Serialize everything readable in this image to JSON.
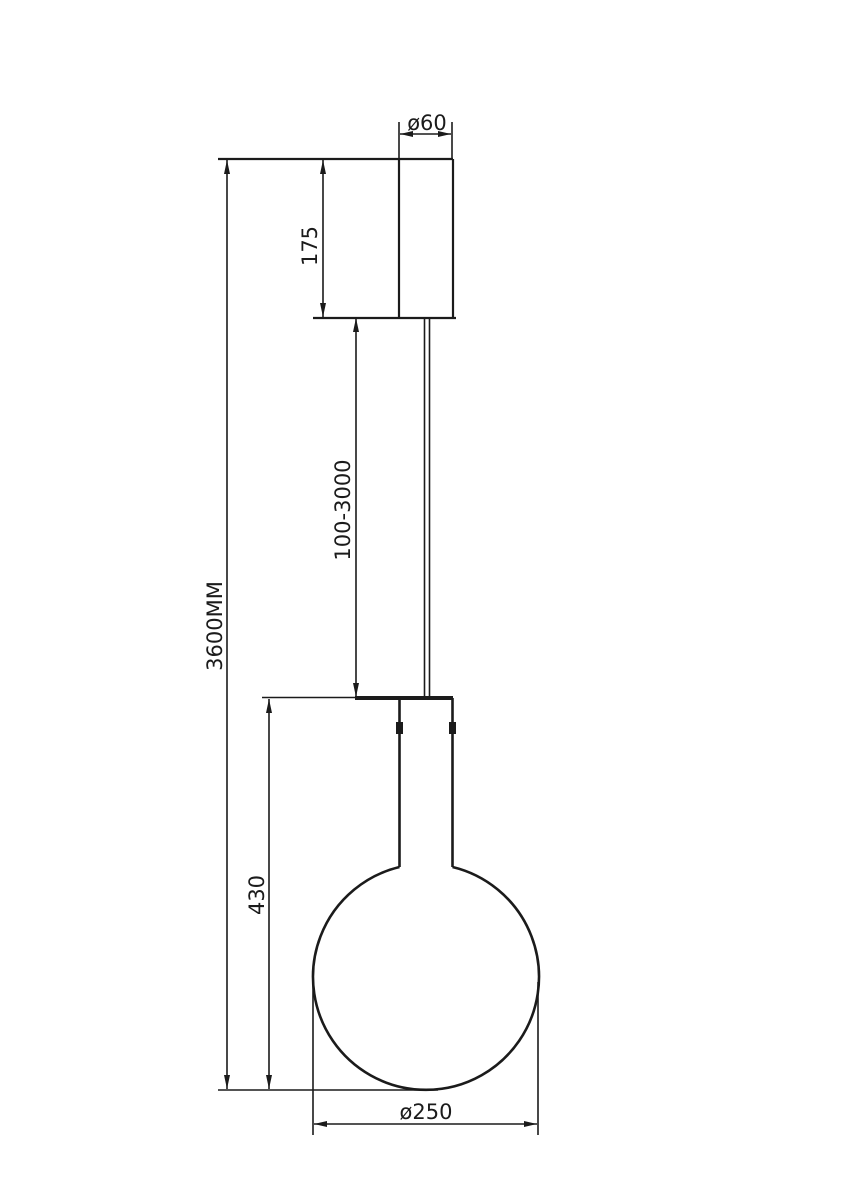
{
  "page": {
    "background": "#ffffff",
    "line_color": "#1b1b1b"
  },
  "drawing": {
    "kind": "technical-dimension-diagram",
    "subject": "pendant-lamp-side-view",
    "labels": {
      "canopy_diameter": "ø60",
      "canopy_height": "175",
      "cable_length_range": "100-3000",
      "total_height": "3600MM",
      "lamp_height": "430",
      "shade_diameter": "ø250"
    }
  }
}
